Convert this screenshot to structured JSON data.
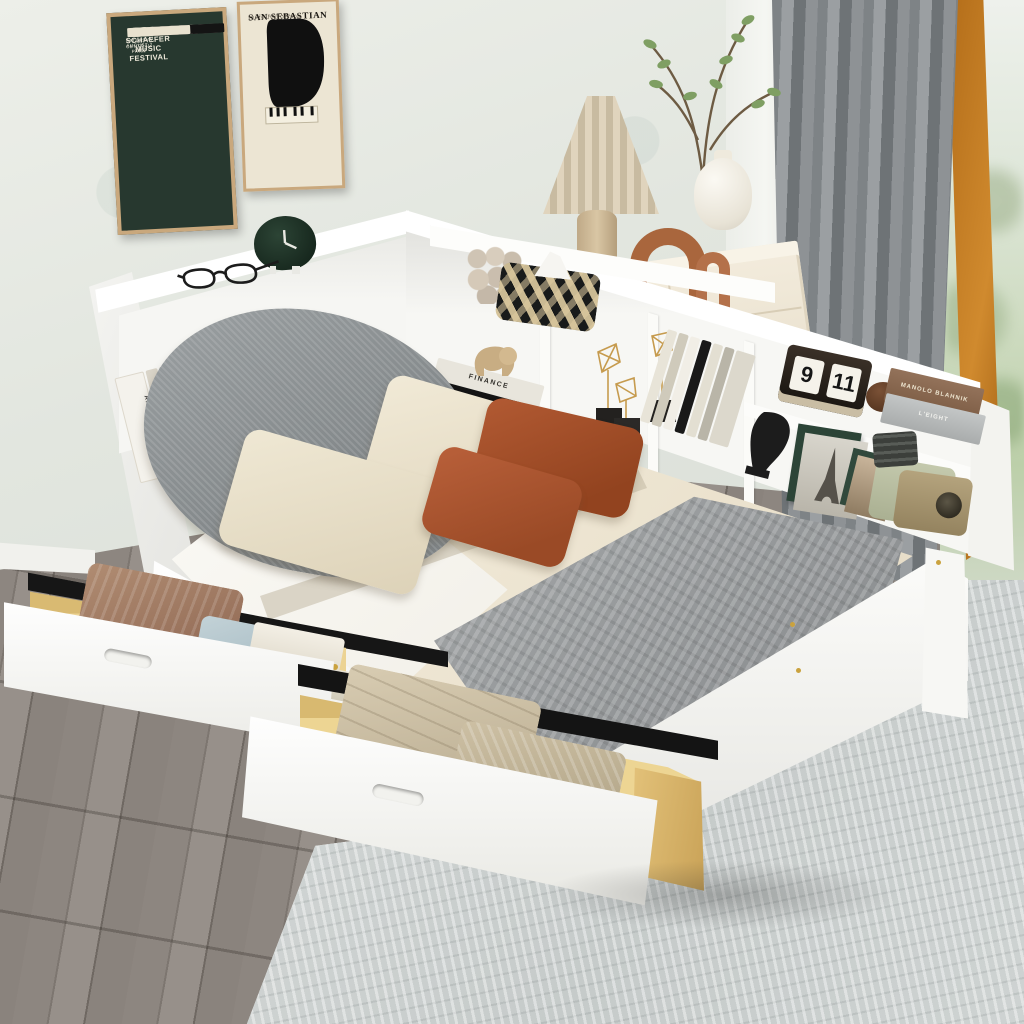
{
  "posters": {
    "left": {
      "title": "SCHAEFER MUSIC FESTIVAL",
      "subtitle": "IN CENTRAL PARK",
      "date": "SATURDAY, AUGUST 2, 1967"
    },
    "right": {
      "title": "SAN SEBASTIAN",
      "subtitle": "JAZZ FESTIVAL",
      "date": "21-26 JULIO 2000"
    }
  },
  "shelf_items": {
    "flip_calendar": {
      "month": "9",
      "day": "11"
    },
    "book_spines": {
      "architecture": "ARCHITECTURE",
      "finance": "FINANCE",
      "manolo": "MANOLO BLAHNIK",
      "leight": "L'EIGHT"
    }
  },
  "colors": {
    "wall": "#e7e9e4",
    "poster_green": "#27382f",
    "poster_cream": "#ece5d3",
    "frame_tan": "#c9a87d",
    "bed_white": "#fbfbf9",
    "sheet_cream": "#ece3cf",
    "pillow_rust": "#a7542f",
    "pillow_gray": "#8f9395",
    "blanket_gray": "#9a9d9f",
    "drawer_wood": "#ecd393",
    "curtain_gray": "#84898c",
    "window_frame_orange": "#c07a20",
    "floor_gray": "#8a837d",
    "rug_gray": "#ced3d2",
    "dresser_cream": "#efe7d8",
    "accent_gold": "#c9a232",
    "clock_green": "#21362a",
    "radio_sage": "#b8bd9f",
    "arch_terracotta": "#a9663d"
  }
}
